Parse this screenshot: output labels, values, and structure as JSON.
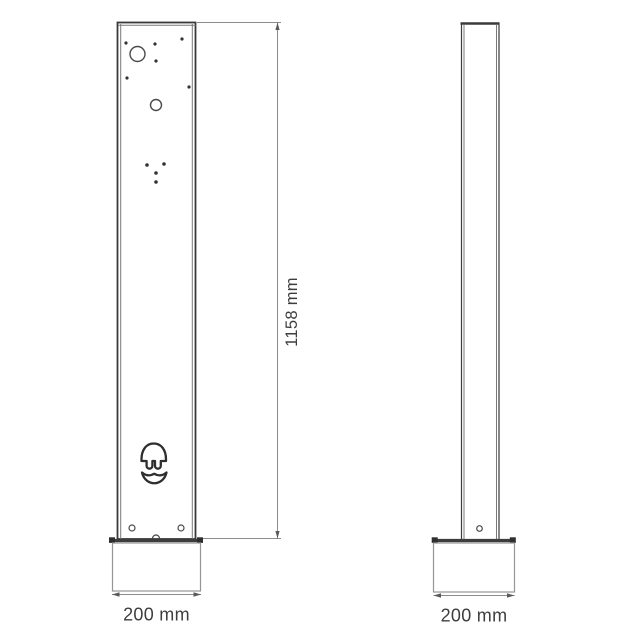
{
  "document": {
    "type": "technical-dimension-drawing",
    "subject": "charging pedestal column, front and side views"
  },
  "colors": {
    "background": "#ffffff",
    "line_dark": "#3a3a3a",
    "line_mid": "#6e6e6e",
    "line_light": "#969696",
    "text": "#3e3e3e"
  },
  "icons": {
    "ev_plug_icon": "stylized EV plug head with two pins above an open socket bowl, outline style"
  },
  "dimensions": {
    "height": "1158 mm",
    "front_base_width": "200 mm",
    "side_base_width": "200 mm"
  }
}
